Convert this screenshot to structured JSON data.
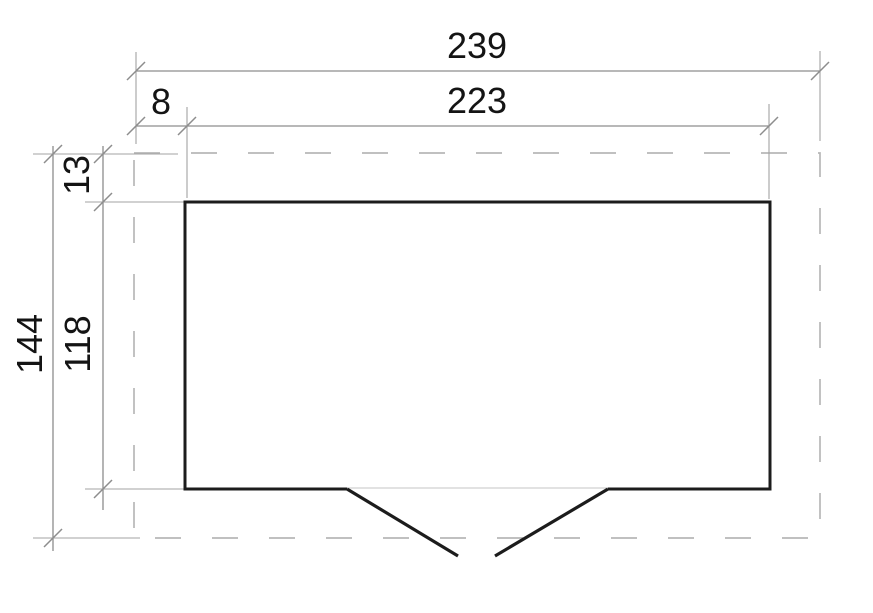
{
  "drawing": {
    "type": "floor-plan-top-view",
    "labels": {
      "overall_width": "239",
      "wall_width": "223",
      "side_offset": "8",
      "overall_depth": "144",
      "wall_depth": "118",
      "front_offset": "13"
    },
    "colors": {
      "wall": "#1c1c1c",
      "dimension": "#8d8d8d",
      "extension": "#a3a3a3",
      "dashed": "#b7b7b7",
      "threshold": "#c4c4c4",
      "text": "#141414",
      "background": "#ffffff"
    }
  }
}
